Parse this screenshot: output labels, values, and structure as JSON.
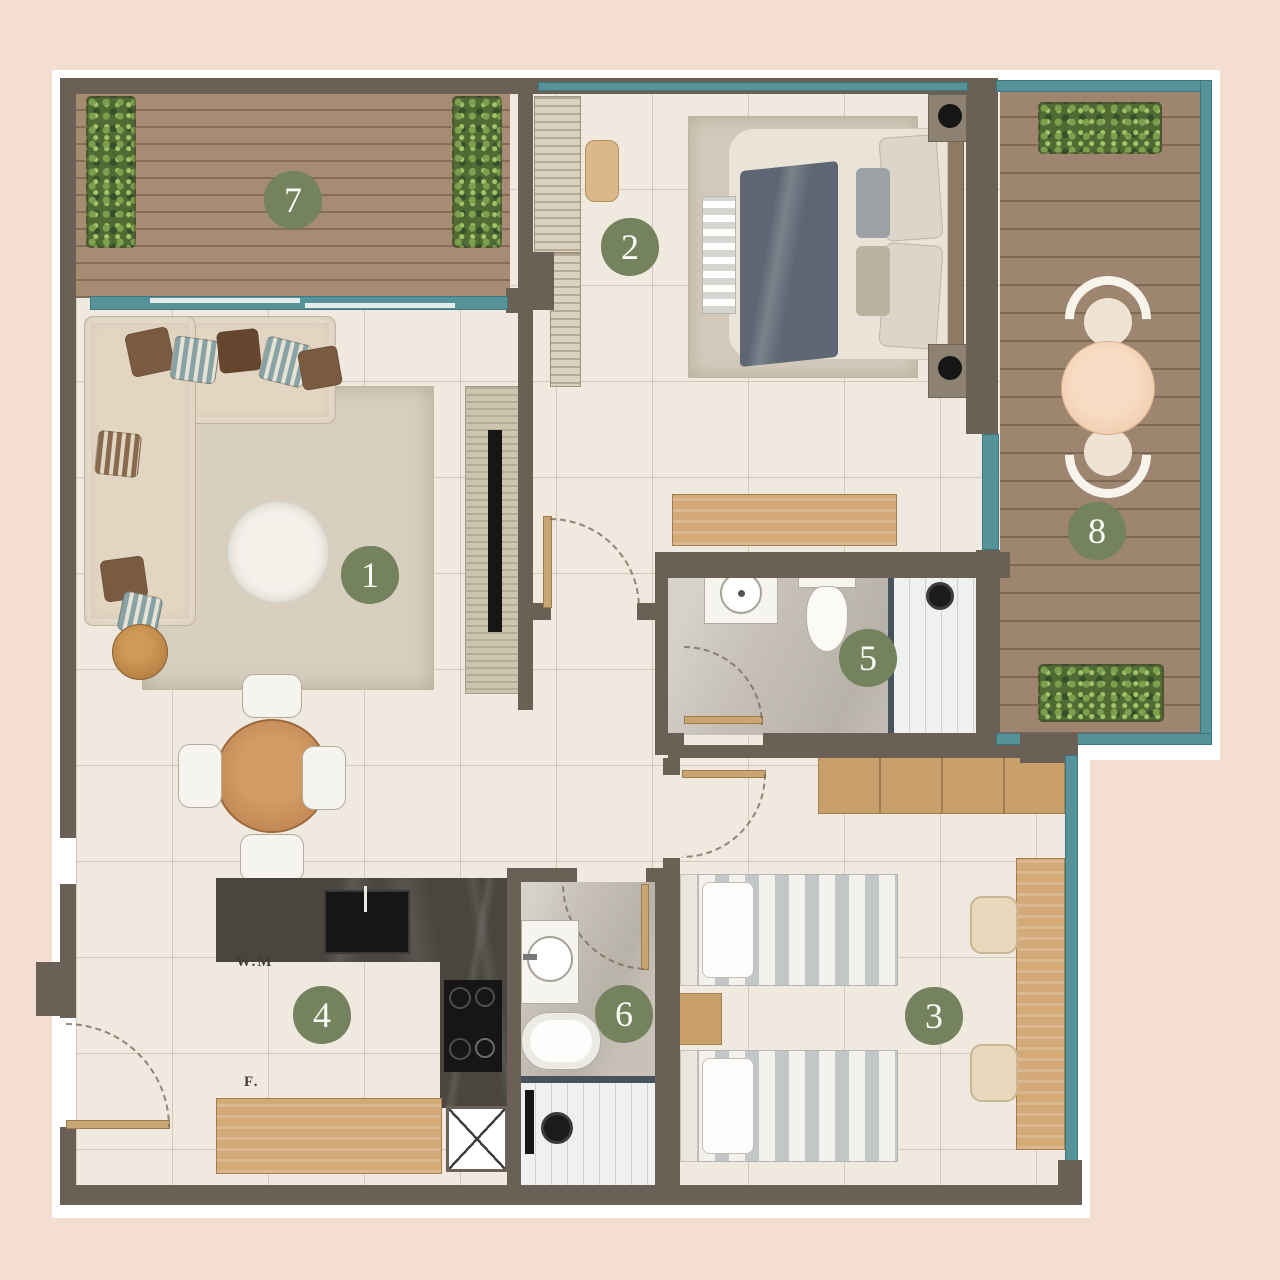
{
  "rooms": [
    {
      "number": "1"
    },
    {
      "number": "2"
    },
    {
      "number": "3"
    },
    {
      "number": "4"
    },
    {
      "number": "5"
    },
    {
      "number": "6"
    },
    {
      "number": "7"
    },
    {
      "number": "8"
    }
  ],
  "kitchen_labels": {
    "washing_machine": "W.M",
    "fridge": "F."
  },
  "colors": {
    "background": "#f4ddd1",
    "wall": "#6b6055",
    "window_frame": "#55929a",
    "badge": "#74825e",
    "deck_wood": "#a58c72",
    "counter_marble": "#4a463f"
  }
}
